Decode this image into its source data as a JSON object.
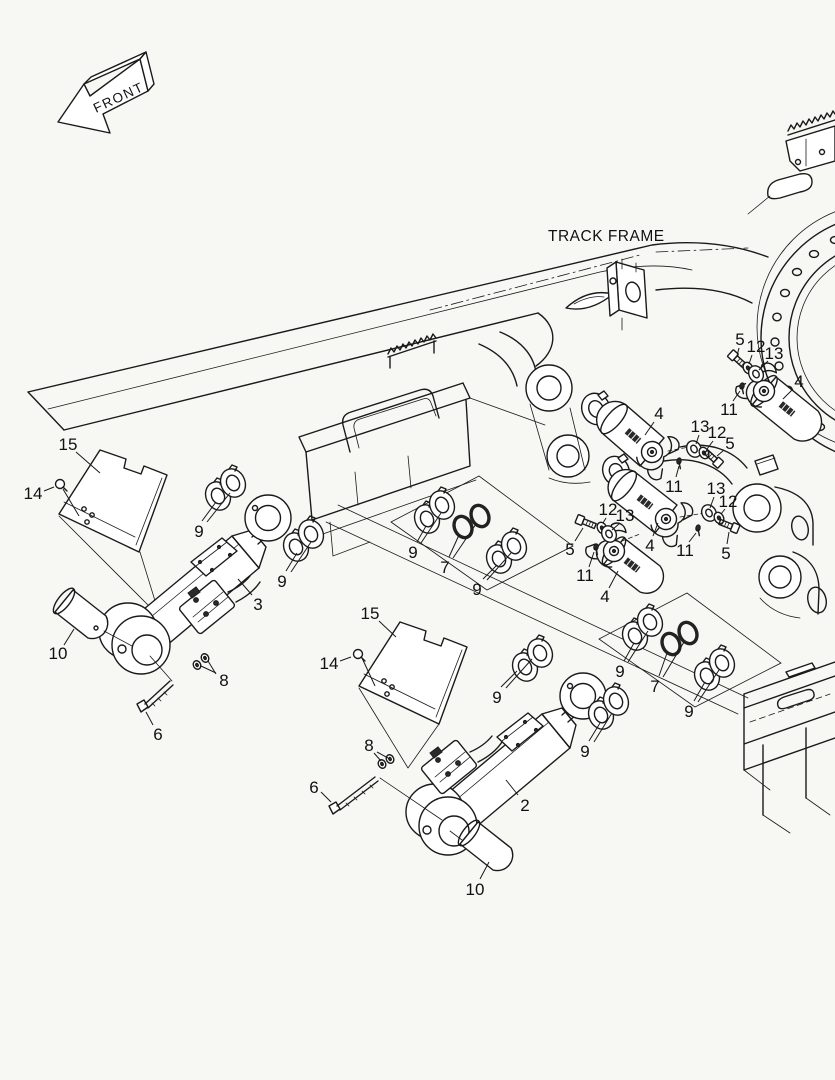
{
  "page": {
    "background": "#f7f7f4",
    "ink": "#1a1a1a",
    "width": 835,
    "height": 1080
  },
  "labels": {
    "front_arrow": "FRONT",
    "track_frame": "TRACK FRAME"
  },
  "icons": [
    {
      "name": "front-direction-arrow",
      "meaning": "3D outline arrow pointing to front-left of machine"
    }
  ],
  "callouts": [
    {
      "n": "15",
      "x": 68,
      "y": 444,
      "lead": [
        [
          76,
          452,
          100,
          473
        ]
      ]
    },
    {
      "n": "14",
      "x": 33,
      "y": 493,
      "lead": [
        [
          44,
          491,
          54,
          487
        ],
        [
          63,
          489,
          79,
          516
        ]
      ]
    },
    {
      "n": "9",
      "x": 199,
      "y": 531,
      "lead": [
        [
          202,
          521,
          216,
          502
        ],
        [
          207,
          522,
          230,
          493
        ]
      ]
    },
    {
      "n": "9",
      "x": 282,
      "y": 581,
      "lead": [
        [
          286,
          571,
          297,
          553
        ],
        [
          291,
          572,
          311,
          542
        ]
      ]
    },
    {
      "n": "3",
      "x": 258,
      "y": 604,
      "lead": [
        [
          252,
          595,
          238,
          579
        ]
      ]
    },
    {
      "n": "10",
      "x": 58,
      "y": 653,
      "lead": [
        [
          64,
          645,
          74,
          629
        ]
      ]
    },
    {
      "n": "8",
      "x": 224,
      "y": 680,
      "lead": [
        [
          216,
          673,
          201,
          666
        ],
        [
          216,
          674,
          208,
          661
        ]
      ]
    },
    {
      "n": "6",
      "x": 158,
      "y": 734,
      "lead": [
        [
          153,
          725,
          146,
          712
        ]
      ]
    },
    {
      "n": "15",
      "x": 370,
      "y": 613,
      "lead": [
        [
          379,
          621,
          396,
          637
        ]
      ]
    },
    {
      "n": "14",
      "x": 329,
      "y": 663,
      "lead": [
        [
          340,
          661,
          351,
          657
        ],
        [
          362,
          658,
          375,
          686
        ]
      ]
    },
    {
      "n": "9",
      "x": 497,
      "y": 697,
      "lead": [
        [
          501,
          687,
          517,
          671
        ],
        [
          506,
          688,
          532,
          659
        ]
      ]
    },
    {
      "n": "2",
      "x": 525,
      "y": 805,
      "lead": [
        [
          518,
          795,
          506,
          780
        ]
      ]
    },
    {
      "n": "9",
      "x": 585,
      "y": 751,
      "lead": [
        [
          589,
          741,
          600,
          723
        ],
        [
          594,
          742,
          612,
          713
        ]
      ]
    },
    {
      "n": "10",
      "x": 475,
      "y": 889,
      "lead": [
        [
          480,
          879,
          489,
          862
        ]
      ]
    },
    {
      "n": "8",
      "x": 369,
      "y": 745,
      "lead": [
        [
          374,
          753,
          381,
          761
        ],
        [
          377,
          752,
          388,
          758
        ]
      ]
    },
    {
      "n": "6",
      "x": 314,
      "y": 787,
      "lead": [
        [
          321,
          792,
          331,
          802
        ]
      ]
    },
    {
      "n": "9",
      "x": 413,
      "y": 552,
      "lead": [
        [
          417,
          542,
          426,
          526
        ],
        [
          421,
          543,
          441,
          513
        ]
      ]
    },
    {
      "n": "7",
      "x": 445,
      "y": 567,
      "lead": [
        [
          449,
          557,
          459,
          535
        ],
        [
          453,
          558,
          476,
          524
        ]
      ]
    },
    {
      "n": "9",
      "x": 477,
      "y": 589,
      "lead": [
        [
          483,
          579,
          497,
          565
        ],
        [
          487,
          580,
          511,
          553
        ]
      ]
    },
    {
      "n": "9",
      "x": 620,
      "y": 671,
      "lead": [
        [
          624,
          661,
          634,
          643
        ],
        [
          628,
          662,
          648,
          631
        ]
      ]
    },
    {
      "n": "7",
      "x": 655,
      "y": 686,
      "lead": [
        [
          659,
          676,
          667,
          653
        ],
        [
          663,
          677,
          684,
          642
        ]
      ]
    },
    {
      "n": "9",
      "x": 689,
      "y": 711,
      "lead": [
        [
          694,
          701,
          705,
          682
        ],
        [
          698,
          702,
          719,
          670
        ]
      ]
    },
    {
      "n": "4",
      "x": 659,
      "y": 413,
      "lead": [
        [
          654,
          422,
          645,
          435
        ]
      ]
    },
    {
      "n": "11",
      "x": 674,
      "y": 486,
      "lead": [
        [
          676,
          477,
          679,
          466
        ]
      ]
    },
    {
      "n": "13",
      "x": 700,
      "y": 426,
      "lead": [
        [
          699,
          435,
          696,
          444
        ]
      ]
    },
    {
      "n": "12",
      "x": 717,
      "y": 432,
      "lead": [
        [
          713,
          441,
          707,
          449
        ]
      ]
    },
    {
      "n": "5",
      "x": 730,
      "y": 443,
      "lead": [
        [
          724,
          450,
          717,
          456
        ]
      ]
    },
    {
      "n": "4",
      "x": 650,
      "y": 545,
      "lead": [
        [
          653,
          536,
          658,
          523
        ]
      ]
    },
    {
      "n": "13",
      "x": 716,
      "y": 488,
      "lead": [
        [
          714,
          497,
          710,
          508
        ]
      ]
    },
    {
      "n": "12",
      "x": 728,
      "y": 501,
      "lead": [
        [
          725,
          509,
          721,
          514
        ]
      ]
    },
    {
      "n": "5",
      "x": 726,
      "y": 553,
      "lead": [
        [
          727,
          544,
          729,
          532
        ]
      ]
    },
    {
      "n": "11",
      "x": 685,
      "y": 550,
      "lead": [
        [
          689,
          542,
          696,
          533
        ]
      ]
    },
    {
      "n": "12",
      "x": 608,
      "y": 509,
      "lead": [
        [
          606,
          518,
          603,
          523
        ]
      ]
    },
    {
      "n": "13",
      "x": 625,
      "y": 515,
      "lead": [
        [
          620,
          523,
          612,
          530
        ]
      ]
    },
    {
      "n": "5",
      "x": 570,
      "y": 549,
      "lead": [
        [
          575,
          541,
          583,
          528
        ]
      ]
    },
    {
      "n": "11",
      "x": 585,
      "y": 575,
      "lead": [
        [
          589,
          567,
          594,
          552
        ]
      ]
    },
    {
      "n": "4",
      "x": 605,
      "y": 596,
      "lead": [
        [
          609,
          588,
          618,
          571
        ]
      ]
    },
    {
      "n": "5",
      "x": 740,
      "y": 339,
      "lead": [
        [
          739,
          348,
          737,
          356
        ]
      ]
    },
    {
      "n": "12",
      "x": 756,
      "y": 346,
      "lead": [
        [
          752,
          355,
          749,
          364
        ]
      ]
    },
    {
      "n": "13",
      "x": 774,
      "y": 353,
      "lead": [
        [
          768,
          361,
          759,
          370
        ]
      ]
    },
    {
      "n": "11",
      "x": 729,
      "y": 409,
      "lead": [
        [
          733,
          401,
          740,
          391
        ]
      ]
    },
    {
      "n": "4",
      "x": 799,
      "y": 381,
      "lead": [
        [
          793,
          389,
          783,
          399
        ]
      ]
    }
  ]
}
